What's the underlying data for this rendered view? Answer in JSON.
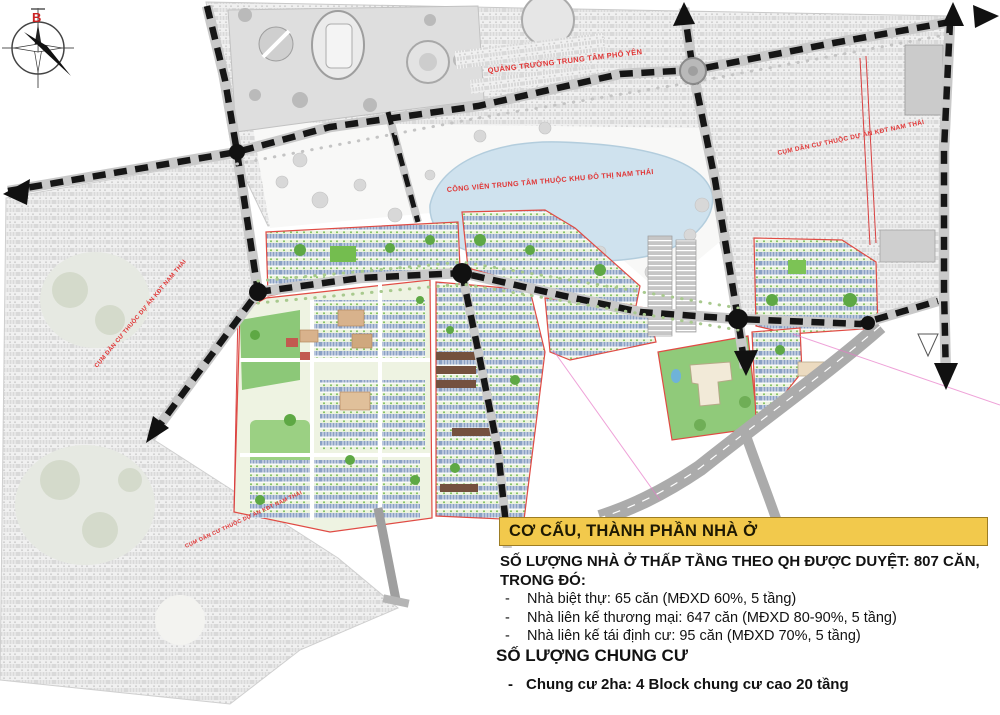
{
  "compass": {
    "north_label": "B"
  },
  "map_labels": {
    "plaza": "QUẢNG TRƯỜNG TRUNG TÂM PHỔ YÊN",
    "central_park": "CÔNG VIÊN TRUNG TÂM THUỘC KHU ĐÔ THỊ NAM THÁI",
    "cluster_left": "CỤM DÂN CƯ THUỘC DỰ ÁN KĐT NAM THÁI",
    "cluster_bottom_left": "CỤM DÂN CƯ THUỘC DỰ ÁN KĐT NAM THÁI",
    "cluster_right": "CỤM DÂN CƯ THUỘC DỰ ÁN KĐT NAM THÁI"
  },
  "info_panel": {
    "title": "CƠ CẤU, THÀNH PHẦN NHÀ Ở",
    "bullet_marker": "-",
    "low_rise": {
      "heading_line1": "SỐ LƯỢNG NHÀ Ở THẤP TẦNG THEO QH ĐƯỢC DUYỆT: 807 CĂN,",
      "heading_line2": "TRONG ĐÓ:",
      "items": [
        {
          "text": "Nhà biệt thự: 65 căn (MĐXD 60%, 5 tầng)"
        },
        {
          "text": "Nhà liên kế thương mại: 647 căn (MĐXD 80-90%, 5 tầng)"
        },
        {
          "text": "Nhà liên kế tái định cư: 95 căn (MĐXD 70%, 5 tầng)"
        }
      ]
    },
    "apartment": {
      "heading": "SỐ LƯỢNG CHUNG CƯ",
      "items": [
        {
          "text": "Chung cư 2ha: 4 Block chung cư cao 20 tầng"
        }
      ]
    }
  },
  "colors": {
    "banner_yellow": "#F2C94C",
    "label_red": "#E03636",
    "boundary_red": "#E04B44",
    "lake_blue": "#CFE2EE",
    "housing_blue": "#8BA1C4",
    "park_green": "#8CC878",
    "road_black": "#161616",
    "road_gray": "#ABABAB"
  }
}
